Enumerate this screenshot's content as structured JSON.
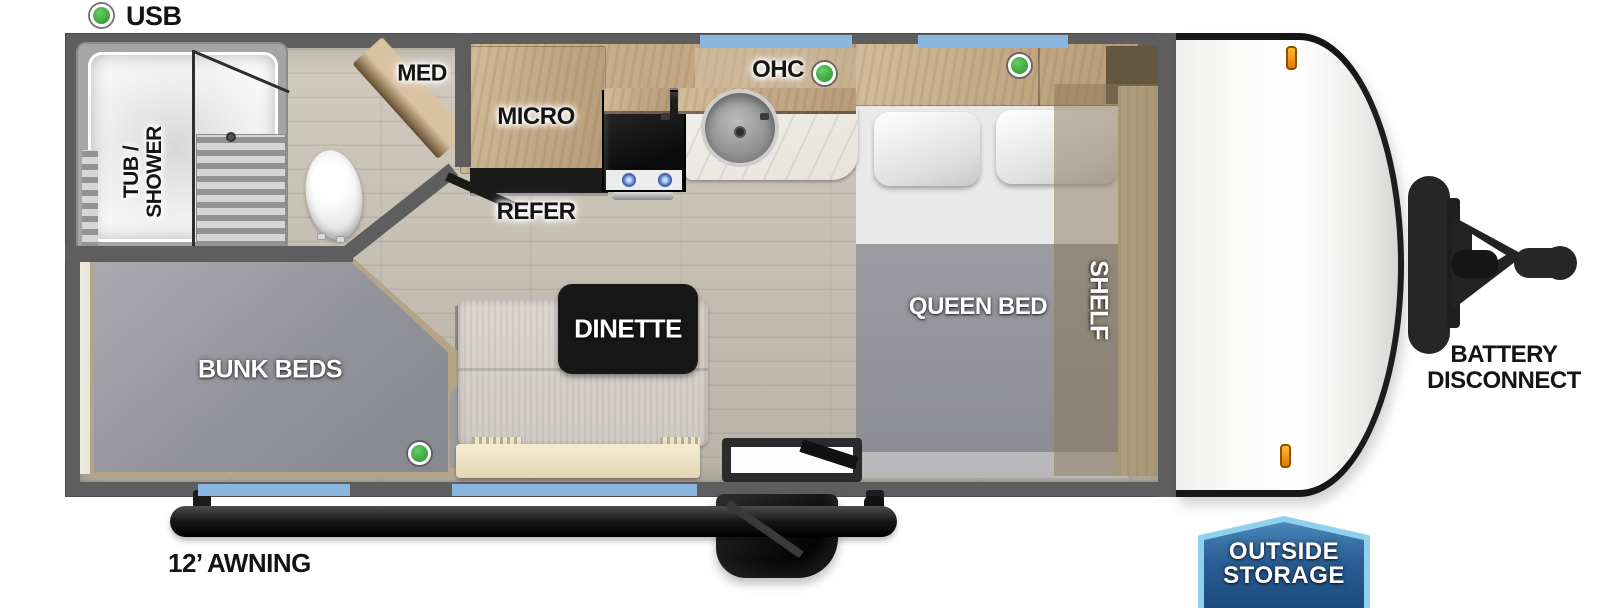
{
  "legend": {
    "usb": "USB"
  },
  "rooms": {
    "tub_shower_line1": "TUB /",
    "tub_shower_line2": "SHOWER",
    "med": "MED",
    "micro": "MICRO",
    "refer": "REFER",
    "ohc": "OHC",
    "dinette": "DINETTE",
    "bunk_beds": "BUNK BEDS",
    "queen_bed": "QUEEN BED",
    "shelf": "SHELF"
  },
  "exterior": {
    "awning": "12’ AWNING",
    "battery_line1": "BATTERY",
    "battery_line2": "DISCONNECT",
    "outside_storage_line1": "OUTSIDE",
    "outside_storage_line2": "STORAGE"
  },
  "icons": {
    "usb_indicator": "green-dot",
    "usb_locations": [
      "legend",
      "kitchen-overhead-cabinet",
      "bedroom-overhead-cabinet",
      "bunk-bed"
    ],
    "windows": [
      "top-1",
      "top-2",
      "bottom-1",
      "bottom-2"
    ]
  },
  "colors": {
    "wall_gray": "#5e5e5e",
    "window_blue": "#8ab7e0",
    "usb_green": "#3cab43",
    "marker_orange": "#f29d18",
    "badge_fill": "#2e6ba3",
    "badge_border": "#8ed2f0",
    "label_black": "#141414",
    "label_white": "#ffffff"
  }
}
